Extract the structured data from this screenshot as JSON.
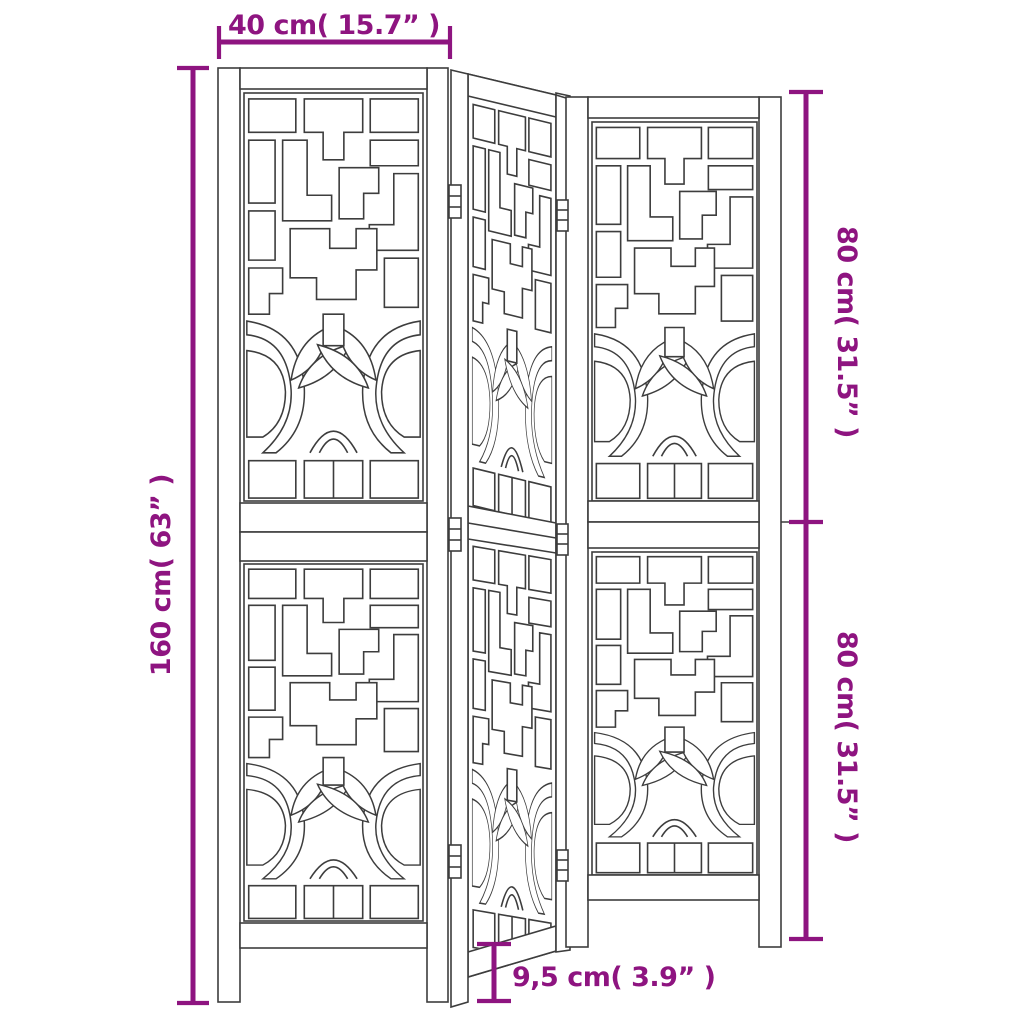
{
  "diagram": {
    "product": "3-panel folding room divider with fretwork",
    "panel_count": 3,
    "colors": {
      "dimension": "#8E1480",
      "line_art": "#3D3D3D",
      "background": "#FFFFFF"
    },
    "dimensions": {
      "panel_width": "40 cm( 15.7”  )",
      "total_height": "160 cm( 63”  )",
      "upper_section_height": "80 cm( 31.5”  )",
      "lower_section_height": "80 cm( 31.5”  )",
      "ground_clearance": "9,5 cm( 3.9”  )"
    }
  }
}
